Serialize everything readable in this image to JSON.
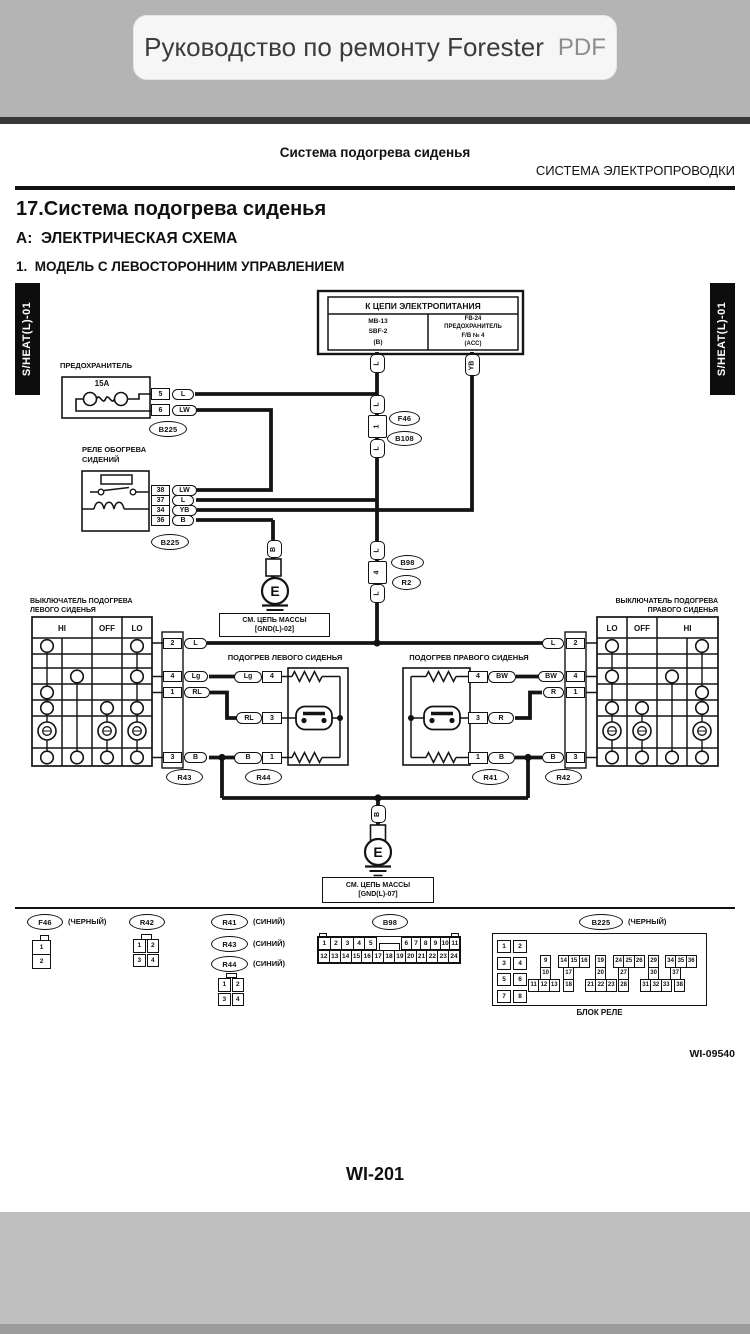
{
  "statusbar": {
    "title": "Руководство по ремонту Forester",
    "badge": "PDF"
  },
  "header": {
    "breadcrumb": "Система подогрева сиденья",
    "section": "СИСТЕМА ЭЛЕКТРОПРОВОДКИ"
  },
  "headings": {
    "h1": "17.Система подогрева сиденья",
    "h2": "A:  ЭЛЕКТРИЧЕСКАЯ СХЕМА",
    "h3": "1.  МОДЕЛЬ С ЛЕВОСТОРОННИМ УПРАВЛЕНИЕМ"
  },
  "diagram": {
    "side_label": "S/HEAT(L)-01",
    "power": {
      "title": "К ЦЕПИ ЭЛЕКТРОПИТАНИЯ",
      "left": "MB-13\nSBF-2\n(B)",
      "right": "FB-24\nПРЕДОХРАНИТЕЛЬ\nF/B № 4\n(ACC)"
    },
    "fuse": {
      "title": "ПРЕДОХРАНИТЕЛЬ",
      "rating": "15A",
      "pins": [
        "5",
        "6"
      ],
      "wires": [
        "L",
        "LW"
      ],
      "connector": "B225"
    },
    "relay": {
      "title": "РЕЛЕ ОБОГРЕВА\nСИДЕНИЙ",
      "pins": [
        "38",
        "37",
        "34",
        "36"
      ],
      "wires": [
        "LW",
        "L",
        "YB",
        "B"
      ],
      "connector": "B225"
    },
    "trunk": {
      "segments": [
        "L",
        "L",
        "1",
        "L",
        "L",
        "4",
        "L"
      ],
      "yb": "YB",
      "upper_connectors": [
        "F46",
        "B108"
      ],
      "mid_connectors": [
        "B98",
        "R2"
      ]
    },
    "grounds": {
      "left": {
        "wire": "B",
        "symbol": "E",
        "note": "СМ. ЦЕПЬ МАССЫ\n[GND(L)-02]"
      },
      "bottom": {
        "wire": "B",
        "symbol": "E",
        "note": "СМ. ЦЕПЬ МАССЫ\n[GND(L)-07]"
      }
    },
    "left_switch": {
      "title": "ВЫКЛЮЧАТЕЛЬ ПОДОГРЕВА\nЛЕВОГО СИДЕНЬЯ",
      "columns": [
        "HI",
        "OFF",
        "LO"
      ],
      "pins": [
        "2",
        "4",
        "1",
        "3"
      ],
      "wires": [
        "L",
        "Lg",
        "RL",
        "B"
      ],
      "connector": "R43"
    },
    "right_switch": {
      "title": "ВЫКЛЮЧАТЕЛЬ ПОДОГРЕВА\nПРАВОГО СИДЕНЬЯ",
      "columns": [
        "LO",
        "OFF",
        "HI"
      ],
      "pins": [
        "2",
        "4",
        "1",
        "3"
      ],
      "wires": [
        "L",
        "BW",
        "R",
        "B"
      ],
      "connector": "R42"
    },
    "left_heater": {
      "title": "ПОДОГРЕВ ЛЕВОГО СИДЕНЬЯ",
      "pins": [
        "4",
        "3",
        "1"
      ],
      "wires": [
        "Lg",
        "RL",
        "B"
      ],
      "connector": "R44"
    },
    "right_heater": {
      "title": "ПОДОГРЕВ ПРАВОГО СИДЕНЬЯ",
      "pins": [
        "4",
        "3",
        "1"
      ],
      "wires": [
        "BW",
        "R",
        "B"
      ],
      "connector": "R41"
    }
  },
  "pinouts": {
    "f46": {
      "label": "F46",
      "color": "(ЧЕРНЫЙ)",
      "cells": [
        "1",
        "2"
      ]
    },
    "r42": {
      "label": "R42",
      "cells": [
        "1",
        "2",
        "3",
        "4"
      ]
    },
    "blue": {
      "items": [
        {
          "label": "R41",
          "color": "(СИНИЙ)"
        },
        {
          "label": "R43",
          "color": "(СИНИЙ)"
        },
        {
          "label": "R44",
          "color": "(СИНИЙ)"
        }
      ],
      "cells": [
        "1",
        "2",
        "3",
        "4"
      ]
    },
    "b98": {
      "label": "B98",
      "row1a": [
        "1",
        "2",
        "3",
        "4",
        "5"
      ],
      "row1b": [
        "6",
        "7",
        "8",
        "9",
        "10",
        "11"
      ],
      "row2": [
        "12",
        "13",
        "14",
        "15",
        "16",
        "17",
        "18",
        "19",
        "20",
        "21",
        "22",
        "23",
        "24"
      ]
    },
    "b225": {
      "label": "B225",
      "color": "(ЧЕРНЫЙ)",
      "caption": "БЛОК РЕЛЕ",
      "left_pairs": [
        [
          "1",
          "2"
        ],
        [
          "3",
          "4"
        ],
        [
          "5",
          "6"
        ],
        [
          "7",
          "8"
        ]
      ],
      "rowA": [
        [
          "9"
        ],
        [
          "14",
          "15",
          "16"
        ],
        [
          "19"
        ],
        [
          "24",
          "25",
          "26"
        ],
        [
          "29"
        ],
        [
          "34",
          "35",
          "36"
        ]
      ],
      "rowB": [
        [
          "10"
        ],
        [
          "17"
        ],
        [
          "20"
        ],
        [
          "27"
        ],
        [
          "30"
        ],
        [
          "37"
        ]
      ],
      "rowC": [
        [
          "11",
          "12",
          "13"
        ],
        [
          "18"
        ],
        [
          "21",
          "22",
          "23"
        ],
        [
          "28"
        ],
        [
          "31",
          "32",
          "33"
        ],
        [
          "38"
        ]
      ]
    }
  },
  "footer": {
    "doc_code": "WI-09540",
    "page_code": "WI-201"
  }
}
